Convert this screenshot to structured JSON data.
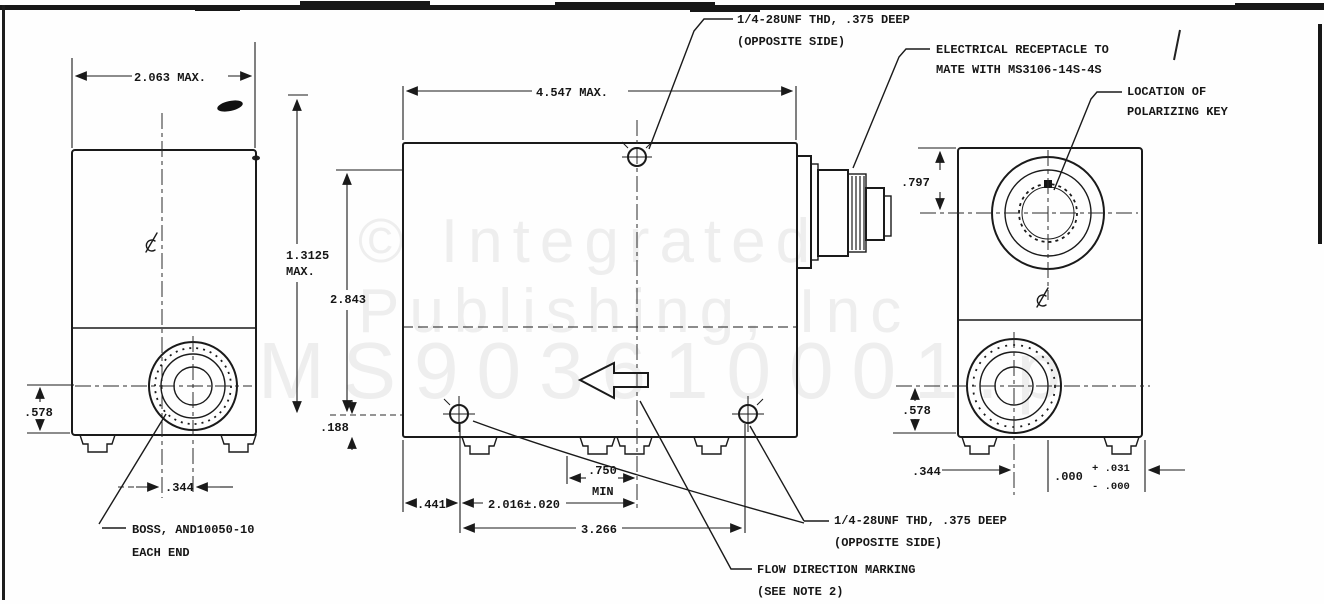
{
  "page": {
    "background": "#fefefe",
    "ink": "#1a1a1a",
    "watermark_color": "#ececec"
  },
  "watermark": {
    "line1": "© Integrated",
    "line2": "Publishing, Inc",
    "line3": "MS903610001.p"
  },
  "callouts": {
    "thd_top": {
      "line1": "1/4-28UNF THD, .375 DEEP",
      "line2": "(OPPOSITE SIDE)"
    },
    "receptacle": {
      "line1": "ELECTRICAL RECEPTACLE TO",
      "line2": "MATE WITH MS3106-14S-4S"
    },
    "polarizing": {
      "line1": "LOCATION OF",
      "line2": "POLARIZING KEY"
    },
    "boss": {
      "line1": "BOSS, AND10050-10",
      "line2": "EACH END"
    },
    "thd_bottom": {
      "line1": "1/4-28UNF THD, .375 DEEP",
      "line2": "(OPPOSITE SIDE)"
    },
    "flow": {
      "line1": "FLOW DIRECTION MARKING",
      "line2": "(SEE NOTE 2)"
    }
  },
  "dims": {
    "left_width": "2.063 MAX.",
    "front_width": "4.547 MAX.",
    "h1": "1.3125",
    "h1b": "MAX.",
    "h2": "2.843",
    "d188": ".188",
    "d578_left": ".578",
    "d344_left": ".344",
    "d441": ".441",
    "d2016": "2.016±.020",
    "d750": ".750",
    "d750_min": "MIN",
    "d3266": "3.266",
    "d797": ".797",
    "d578_right": ".578",
    "d344_right": ".344",
    "tol_main": ".000",
    "tol_plus": "+ .031",
    "tol_minus": "- .000"
  }
}
